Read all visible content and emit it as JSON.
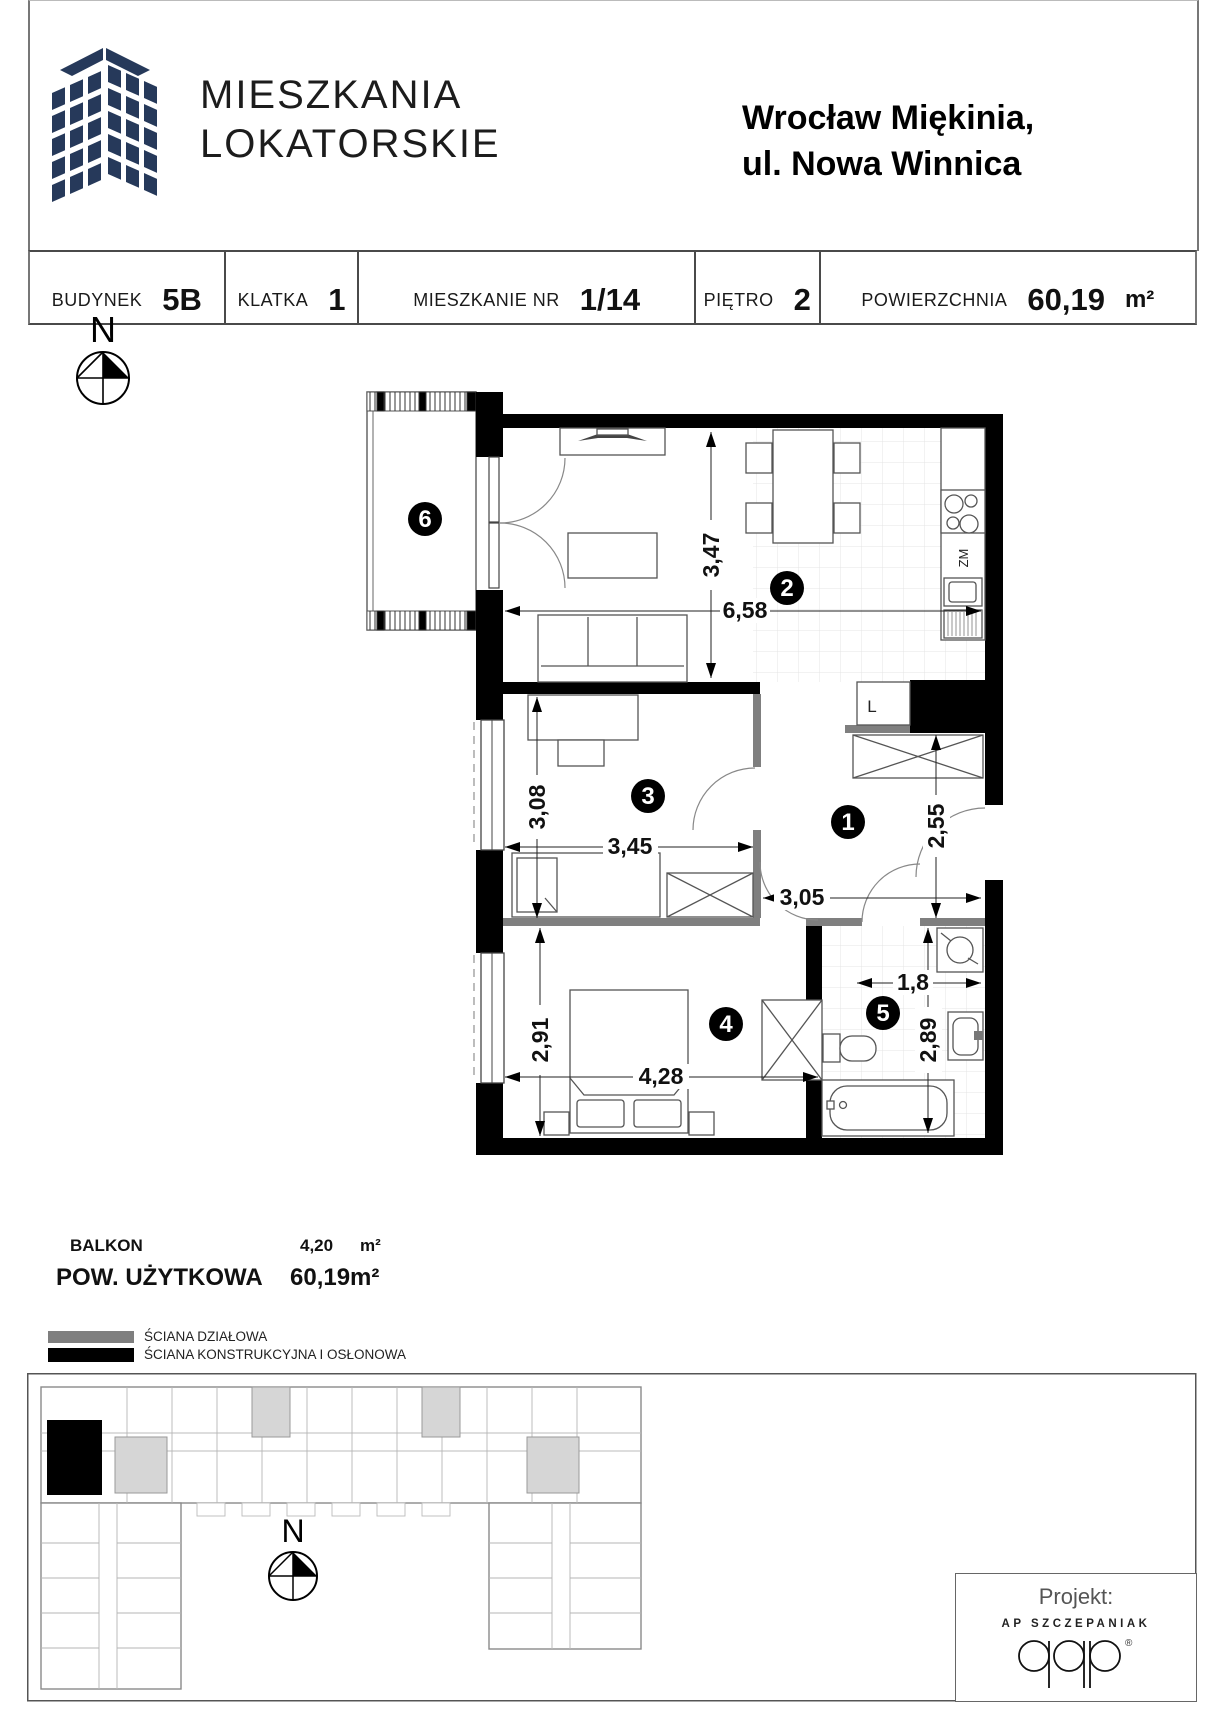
{
  "header": {
    "brand_line1": "MIESZKANIA",
    "brand_line2": "LOKATORSKIE",
    "location_line1": "Wrocław Miękinia,",
    "location_line2": "ul. Nowa Winnica"
  },
  "info_bar": {
    "cells": [
      {
        "label": "BUDYNEK",
        "value": "5B"
      },
      {
        "label": "KLATKA",
        "value": "1"
      },
      {
        "label": "MIESZKANIE NR",
        "value": "1/14"
      },
      {
        "label": "PIĘTRO",
        "value": "2"
      },
      {
        "label": "POWIERZCHNIA",
        "value": "60,19",
        "unit": "m²"
      }
    ]
  },
  "plan": {
    "compass_label": "N",
    "rooms": {
      "r1": "1",
      "r2": "2",
      "r3": "3",
      "r4": "4",
      "r5": "5",
      "r6": "6"
    },
    "dims": {
      "living_h": "3,47",
      "living_w": "6,58",
      "r3_h": "3,08",
      "r3_w": "3,45",
      "hall_h": "2,55",
      "hall_w": "3,05",
      "bath_w": "1,8",
      "bath_h": "2,89",
      "r4_h": "2,91",
      "r4_w": "4,28"
    },
    "labels": {
      "fridge": "L",
      "dishwasher": "ZM"
    }
  },
  "summary": {
    "balkon_label": "BALKON",
    "balkon_value": "4,20",
    "balkon_unit": "m²",
    "area_label": "POW. UŻYTKOWA",
    "area_value": "60,19m²"
  },
  "legend": {
    "partition_label": "ŚCIANA DZIAŁOWA",
    "structural_label": "ŚCIANA KONSTRUKCYJNA I OSŁONOWA"
  },
  "site_plan": {
    "compass_label": "N"
  },
  "footer": {
    "project_label": "Projekt:",
    "architect": "AP SZCZEPANIAK",
    "registered": "®"
  },
  "colors": {
    "brand_navy": "#26395a",
    "wall_black": "#000000",
    "wall_gray": "#7f7f7f"
  }
}
